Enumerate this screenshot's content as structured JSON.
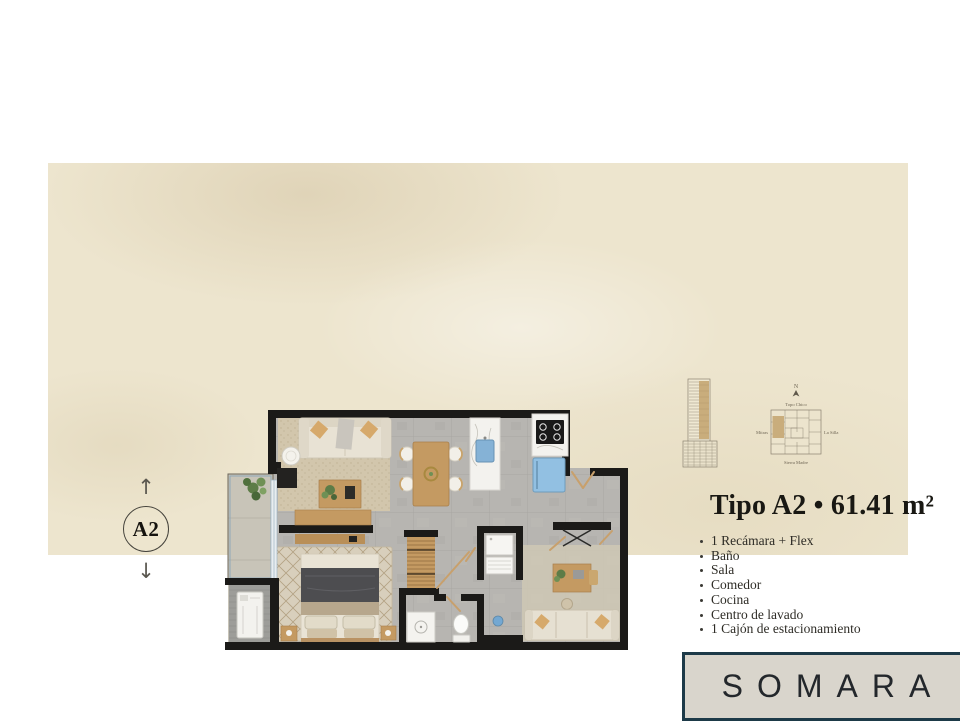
{
  "page": {
    "background": "#ffffff",
    "panel_color": "#ede5ce"
  },
  "unit_marker": {
    "label": "A2",
    "up_arrow": "↑",
    "down_arrow": "↓"
  },
  "title": {
    "text": "Tipo A2 • 61.41 m²"
  },
  "features": [
    "1 Recámara + Flex",
    "Baño",
    "Sala",
    "Comedor",
    "Cocina",
    "Centro de lavado",
    "1 Cajón de estacionamiento"
  ],
  "brand": {
    "name": "SOMARA",
    "border_color": "#1d3a48",
    "background": "#d9d5cc",
    "text_color": "#23272b"
  },
  "location_map": {
    "north_label": "N",
    "labels": {
      "top": "Topo Chico",
      "left": "Mitras",
      "right": "La Silla",
      "bottom": "Sierra Madre"
    },
    "highlight_color": "#c9ad7c"
  },
  "floor_plan": {
    "wall_color": "#1b1a18",
    "floor_color": "#b7b5b1",
    "wood_color": "#c49a62",
    "accent_blue": "#92c0e2",
    "sink_blue": "#85b2d6",
    "elements": [
      "balcony",
      "plant",
      "utility-washer",
      "living-sofa",
      "side-table",
      "coffee-table",
      "media-console",
      "dining-table",
      "kitchen-island",
      "sink",
      "stove",
      "refrigerator",
      "bed",
      "nightstands",
      "wardrobe",
      "laundry-units",
      "toilet",
      "shower",
      "flex-desk",
      "flex-sofa",
      "entry-door"
    ]
  }
}
